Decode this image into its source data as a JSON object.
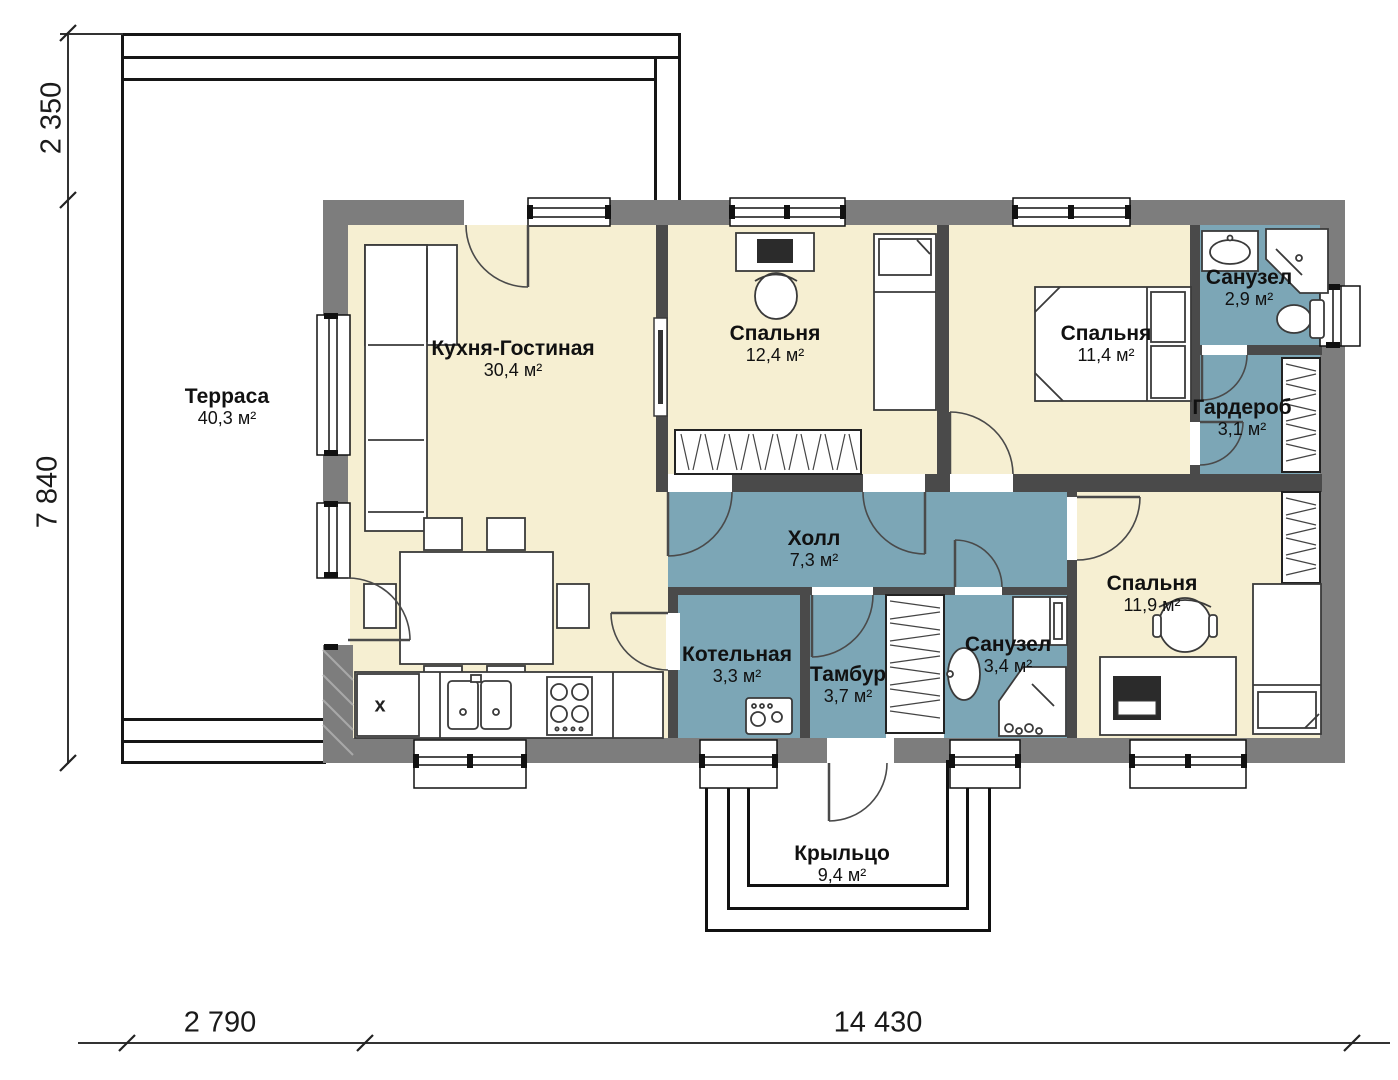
{
  "title": "Поэтажный план одноэтажного дома",
  "colors": {
    "wall-outer": "#7d7d7d",
    "wall-inner": "#4a4a4a",
    "room-cream": "#f6efd2",
    "room-blue": "#7ca6b6",
    "line-black": "#161616"
  },
  "rooms": {
    "terrace": {
      "name": "Терраса",
      "area": "40,3 м²"
    },
    "kitchen_living": {
      "name": "Кухня-Гостиная",
      "area": "30,4 м²",
      "cabinet_marker": "х"
    },
    "bedroom_small": {
      "name": "Спальня",
      "area": "12,4 м²"
    },
    "bedroom_master": {
      "name": "Спальня",
      "area": "11,4 м²"
    },
    "bathroom_master": {
      "name": "Санузел",
      "area": "2,9 м²"
    },
    "wardrobe": {
      "name": "Гардероб",
      "area": "3,1 м²"
    },
    "hall": {
      "name": "Холл",
      "area": "7,3 м²"
    },
    "boiler": {
      "name": "Котельная",
      "area": "3,3 м²"
    },
    "vestibule": {
      "name": "Тамбур",
      "area": "3,7 м²"
    },
    "bathroom_guest": {
      "name": "Санузел",
      "area": "3,4 м²"
    },
    "bedroom_third": {
      "name": "Спальня",
      "area": "11,9 м²"
    },
    "porch": {
      "name": "Крыльцо",
      "area": "9,4 м²"
    }
  },
  "dimensions": {
    "top_left_height": "2 350",
    "left_height": "7 840",
    "bottom_left_width": "2 790",
    "bottom_main_width": "14 430"
  }
}
